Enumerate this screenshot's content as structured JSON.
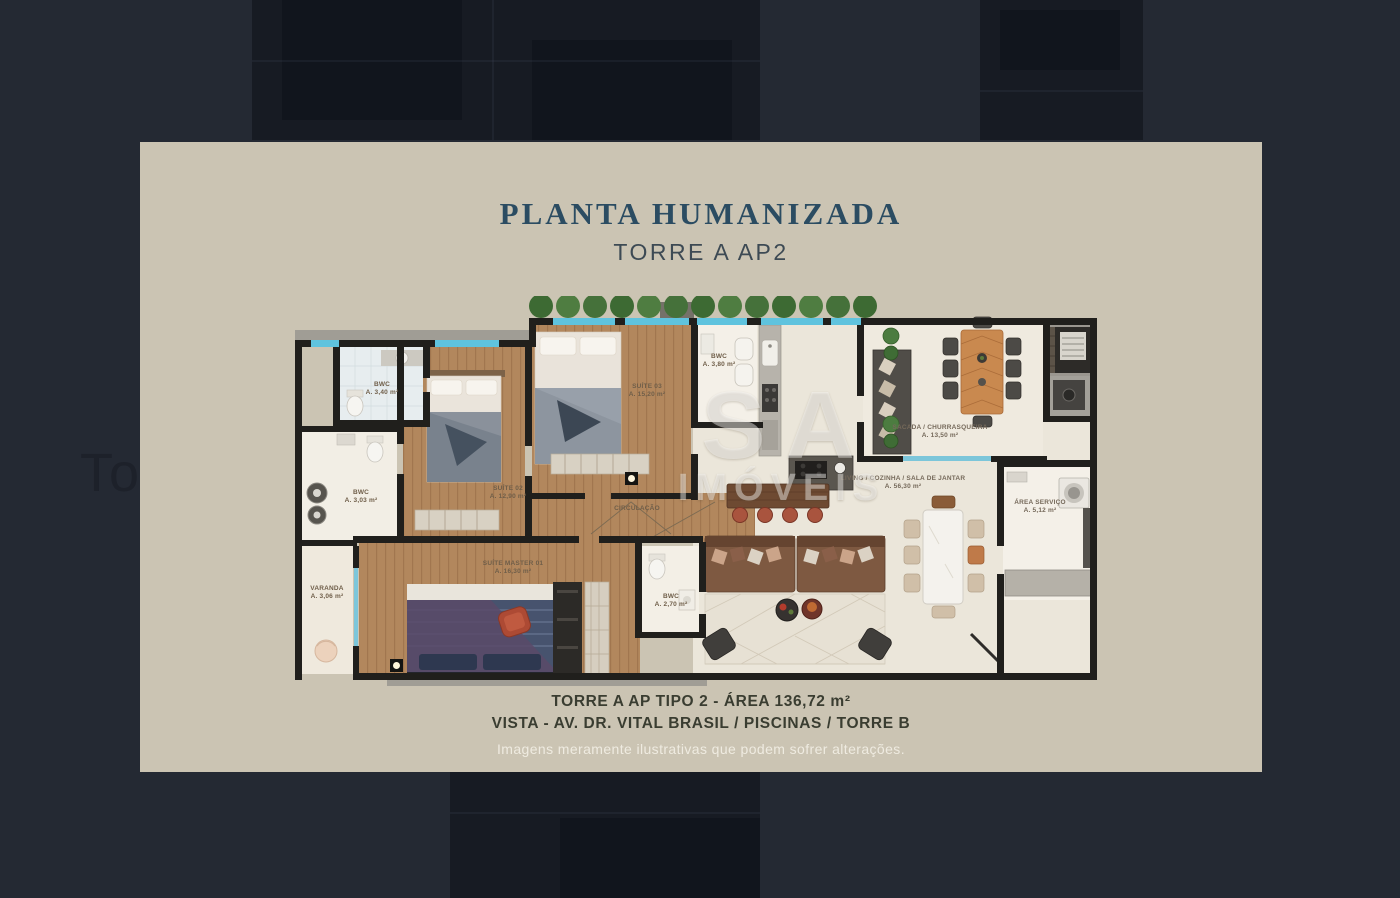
{
  "background": {
    "caption_fragment": "To"
  },
  "card": {
    "title": "PLANTA HUMANIZADA",
    "subtitle": "TORRE A AP2",
    "footer": {
      "line1": "TORRE A AP TIPO 2 - ÁREA 136,72 m²",
      "line2": "VISTA - AV. DR. VITAL BRASIL / PISCINAS / TORRE B",
      "disclaimer": "Imagens meramente ilustrativas que podem sofrer alterações."
    }
  },
  "floorplan": {
    "watermark": {
      "line1": "SA",
      "line2": "IMÓVEIS"
    },
    "rooms": {
      "bwc1": {
        "name": "BWC",
        "area": "A. 3,40 m²"
      },
      "suite03": {
        "name": "SUÍTE 03",
        "area": "A. 15,20 m²"
      },
      "bwc2": {
        "name": "BWC",
        "area": "A. 3,80 m²"
      },
      "sacada": {
        "name": "SACADA / CHURRASQUEIRA",
        "area": "A. 13,50 m²"
      },
      "living": {
        "name": "LIVING / COZINHA / SALA DE JANTAR",
        "area": "A. 56,30 m²"
      },
      "area_servico": {
        "name": "ÁREA SERVIÇO",
        "area": "A. 5,12 m²"
      },
      "bwc3": {
        "name": "BWC",
        "area": "A. 3,03 m²"
      },
      "suite02": {
        "name": "SUÍTE 02",
        "area": "A. 12,90 m²"
      },
      "circulacao": {
        "name": "CIRCULAÇÃO",
        "area": ""
      },
      "varanda": {
        "name": "VARANDA",
        "area": "A. 3,06 m²"
      },
      "suite_master": {
        "name": "SUÍTE MASTER 01",
        "area": "A. 16,30 m²"
      },
      "bwc4": {
        "name": "BWC",
        "area": "A. 2,70 m²"
      }
    }
  },
  "colors": {
    "backdrop": "#242933",
    "card_background": "#cbc4b3",
    "title_text": "#2b4c62",
    "subtitle_text": "#3d4a54",
    "footer_text": "#3a3d31",
    "disclaimer_text": "#f3efe5",
    "wood_floor": "#b2875d",
    "window_glass": "#5fc3de",
    "tree_green": "#4c7c40",
    "wall_black": "#201f1c"
  }
}
